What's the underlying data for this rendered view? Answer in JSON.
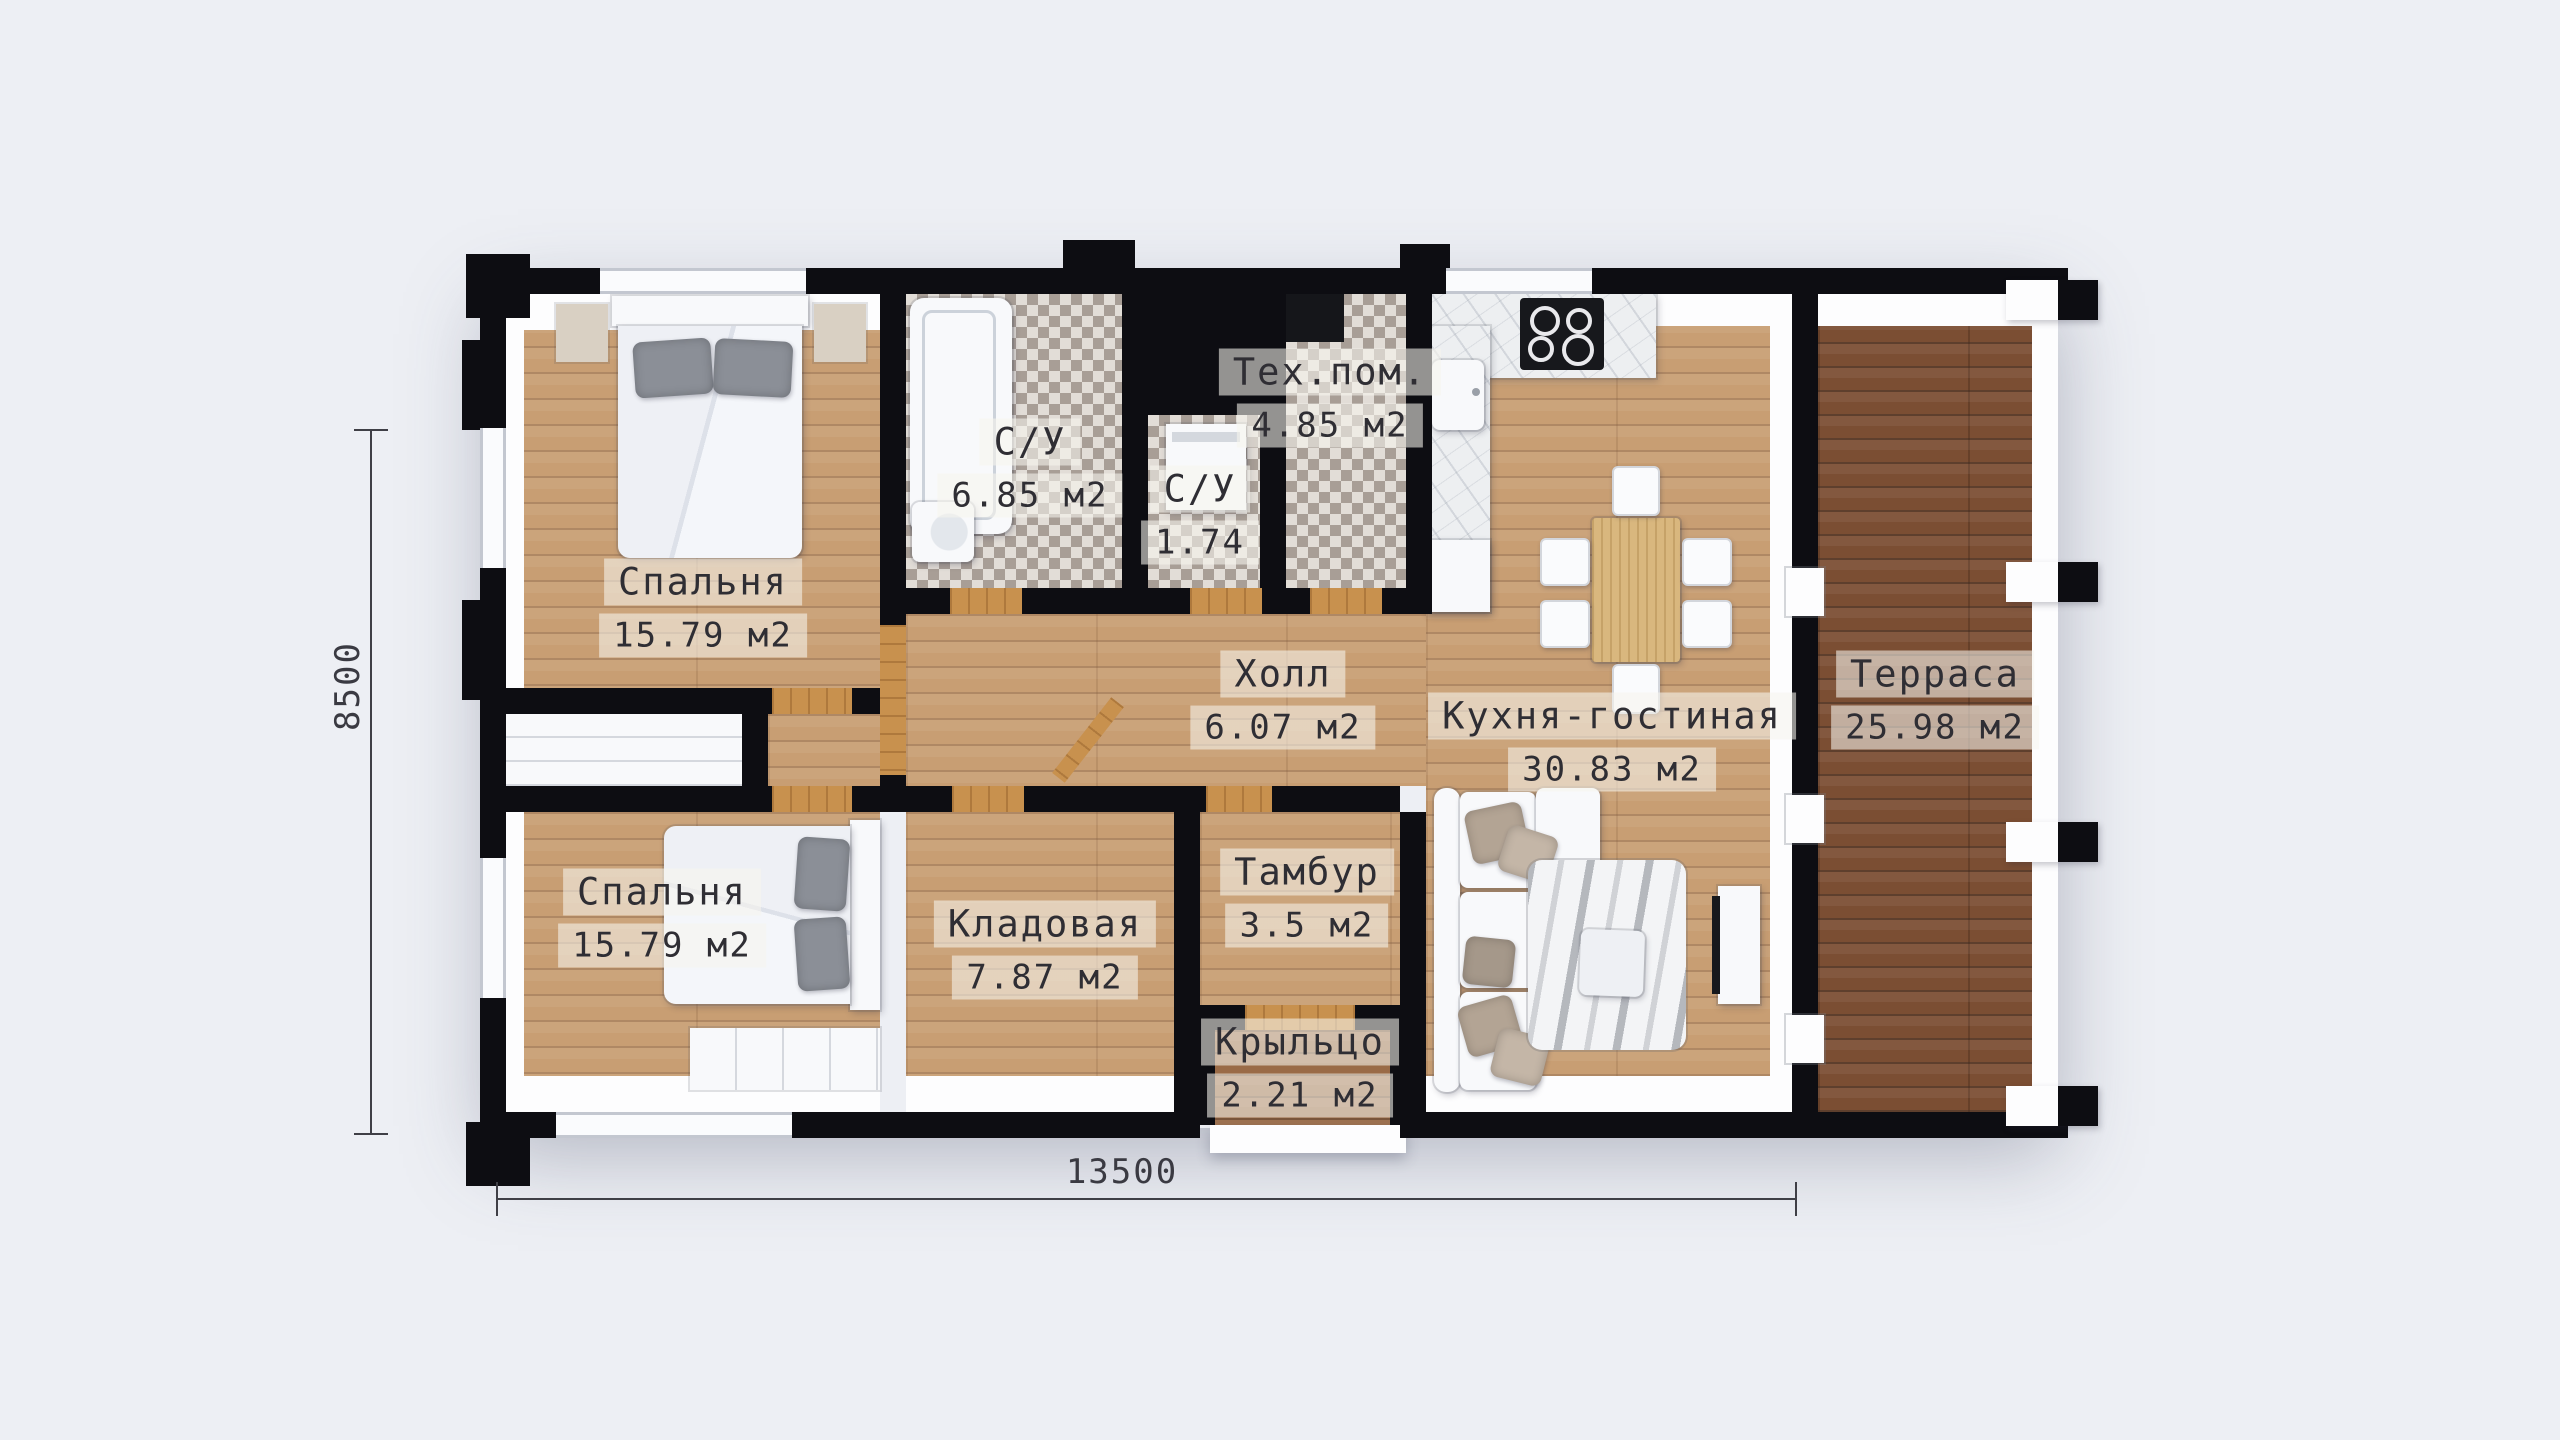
{
  "floor_plan": {
    "title": "one-storey house floor plan",
    "dimensions": {
      "width_label": "13500",
      "height_label": "8500"
    },
    "rooms": [
      {
        "id": "bedroom-1",
        "name": "Спальня",
        "area": "15.79 м2"
      },
      {
        "id": "bathroom-1",
        "name": "С/У",
        "area": "6.85 м2"
      },
      {
        "id": "bathroom-2",
        "name": "С/У",
        "area": "1.74"
      },
      {
        "id": "tech-room",
        "name": "Тех.пом.",
        "area": "4.85 м2"
      },
      {
        "id": "hall",
        "name": "Холл",
        "area": "6.07 м2"
      },
      {
        "id": "kitchen-living",
        "name": "Кухня-гостиная",
        "area": "30.83 м2"
      },
      {
        "id": "terrace",
        "name": "Терраса",
        "area": "25.98 м2"
      },
      {
        "id": "bedroom-2",
        "name": "Спальня",
        "area": "15.79 м2"
      },
      {
        "id": "storage",
        "name": "Кладовая",
        "area": "7.87 м2"
      },
      {
        "id": "vestibule",
        "name": "Тамбур",
        "area": "3.5 м2"
      },
      {
        "id": "porch",
        "name": "Крыльцо",
        "area": "2.21 м2"
      }
    ],
    "colors": {
      "background": "#edeff4",
      "wall": "#0d0d12",
      "wood_floor": "#c89e73",
      "terrace_wood": "#7b4e33",
      "tile_dark": "#a89e96",
      "tile_light": "#e2ddd7",
      "door_threshold": "#c8914e",
      "label_text": "#2f2e34",
      "dimension_text": "#3a3a42"
    }
  }
}
